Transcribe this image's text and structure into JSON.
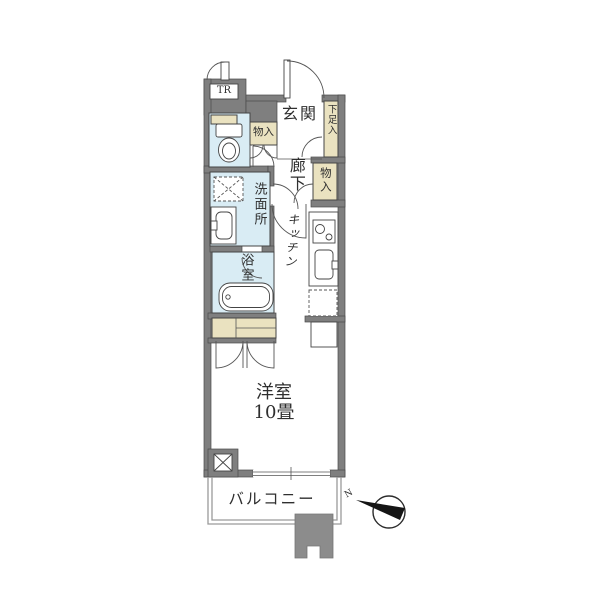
{
  "title": "apartment-floor-plan",
  "labels": {
    "trunk_room": "TR",
    "entrance": "玄関",
    "hallway": "廊下",
    "shoe_storage": "下足入",
    "entrance_storage": "物入",
    "hallway_storage": "物入",
    "washroom": "洗面所",
    "bathroom": "浴室",
    "kitchen": "キッチン",
    "main_room_name": "洋室",
    "main_room_size": "10畳",
    "balcony": "バルコニー",
    "compass_north": "N"
  },
  "colors": {
    "wall": "#7f7f7f",
    "wet_area": "#d9ecf4",
    "storage": "#eae2c0",
    "building_mass": "#8c8c8c",
    "outline": "#454545",
    "balcony_rail": "#9a9a9a",
    "text": "#2f2f2f"
  }
}
